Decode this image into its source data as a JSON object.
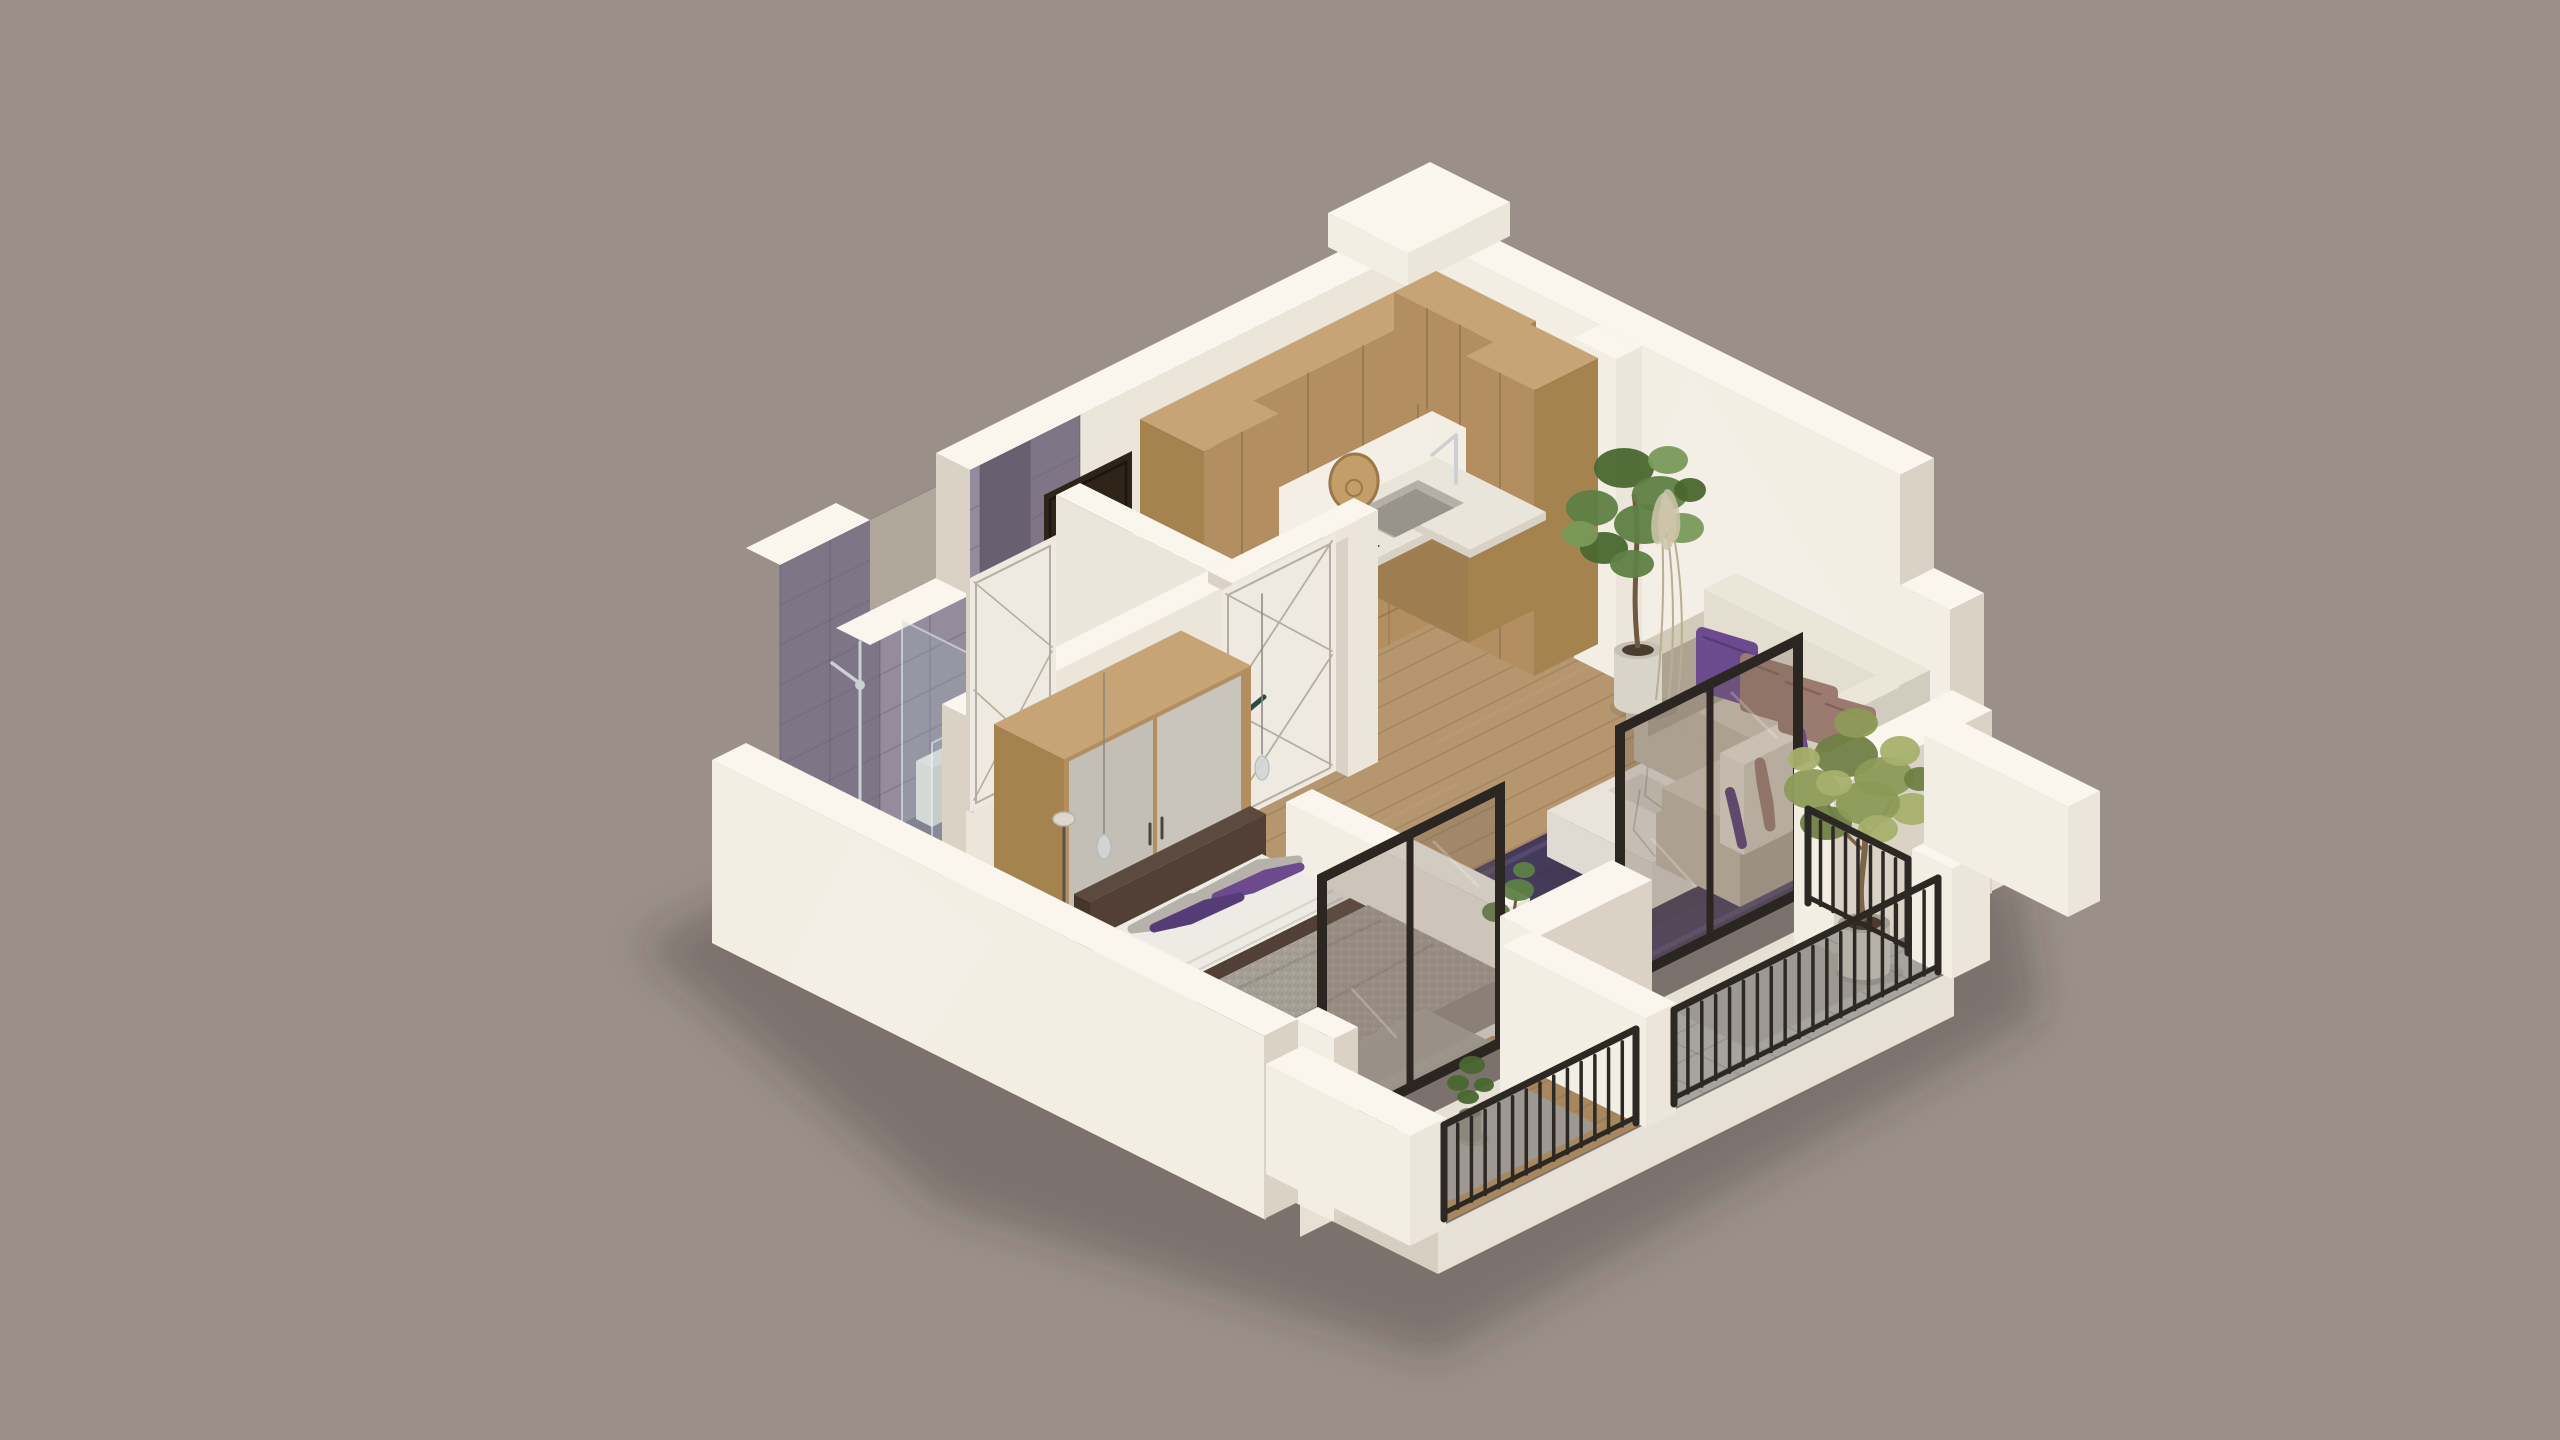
{
  "scene": {
    "type": "isometric-3d-apartment-floor-plan-render",
    "view": "cutaway-axonometric",
    "rooms": [
      {
        "name": "bathroom",
        "features": [
          "marble-tile-wall",
          "window-opening",
          "walk-in-shower-glass",
          "toilet",
          "bathtub",
          "chrome-shower-fixture"
        ]
      },
      {
        "name": "kitchen",
        "features": [
          "l-shaped-wood-cabinets",
          "upper-cabinets",
          "tall-pantry-cabinet",
          "white-countertop",
          "steel-sink",
          "chrome-faucet",
          "dark-cooktop",
          "round-wood-board"
        ]
      },
      {
        "name": "entry-hall",
        "features": [
          "dark-entrance-door",
          "white-door-closed",
          "white-door-open",
          "wardrobe",
          "floor-lamp"
        ]
      },
      {
        "name": "bedroom",
        "features": [
          "double-bed",
          "gray-speckled-blanket",
          "brown-trim",
          "purple-pillows",
          "gray-pillows",
          "pendant-lights",
          "door-mat"
        ]
      },
      {
        "name": "living-room",
        "features": [
          "corner-sofa",
          "cream-back-cushions",
          "purple-accent-pillows",
          "mauve-pillows",
          "purple-rug",
          "marble-coffee-table",
          "potted-ficus",
          "dried-pampas"
        ]
      },
      {
        "name": "balcony-bedroom",
        "features": [
          "glass-door-black-frame",
          "wood-deck-floor",
          "metal-railing",
          "small-potted-plant",
          "door-mat"
        ]
      },
      {
        "name": "balcony-living",
        "features": [
          "glass-door-black-frame",
          "tile-floor",
          "metal-railing",
          "olive-tree-in-concrete-pot",
          "door-mat",
          "white-parapet-piers"
        ]
      }
    ]
  },
  "colors": {
    "background": "#9a9089",
    "wall_top": "#faf6ee",
    "wall_light": "#f3eee4",
    "wall_mid": "#ece6da",
    "wall_shade": "#d9d2c5",
    "wall_dark": "#c7bfb1",
    "slab": "#e7e1d5",
    "slab_shade": "#d5cec1",
    "outside": "#b0a79b",
    "tile_base": "#7e7687",
    "tile_light": "#948b9c",
    "tile_dark": "#686070",
    "grout": "#575064",
    "bath_floor": "#787080",
    "shower_tray": "#888090",
    "wood_cabinet": "#b28e60",
    "wood_cabinet_light": "#c7a475",
    "wood_cabinet_dark": "#96764b",
    "wood_cabinet_side": "#a5834f",
    "counter": "#eae5db",
    "counter_side": "#d8d2c6",
    "cooktop": "#221d18",
    "steel": "#b4b0a8",
    "steel_dark": "#98948c",
    "wood_floor": "#b5966f",
    "wood_floor_dark": "#a8875f",
    "plank_line": "rgba(104,74,44,0.20)",
    "balcony_tile": "#a7a49e",
    "balcony_grid": "rgba(0,0,0,0.10)",
    "door_dark": "#2e2418",
    "door_dark_edge": "#1c1510",
    "door_white": "#efeae1",
    "door_line": "#b5aea0",
    "handle_dark": "#2c4a44",
    "glass_frame": "#2b2621",
    "glass_fill": "rgba(118,102,88,0.30)",
    "glass_shine": "rgba(255,255,255,0.22)",
    "shower_glass": "rgba(158,182,188,0.26)",
    "shower_glass2": "rgba(158,182,188,0.18)",
    "shower_edge": "rgba(235,245,246,0.55)",
    "railing": "#2c2824",
    "sofa": "#c3baa8",
    "sofa_light": "#d3cbba",
    "sofa_shade": "#ada393",
    "sofa_back": "#e4ded1",
    "sofa_back_top": "#ece6d9",
    "sofa_back_shade": "#d2ccbe",
    "pillow_purple": "#6b4a8e",
    "pillow_purple_dark": "#563c76",
    "pillow_mauve": "#9b7a6f",
    "pillow_mauve_dark": "#84615a",
    "rug": "#443a5a",
    "rug_light": "#5a4d73",
    "marble": "#e9e4db",
    "marble_side": "#d9d4ca",
    "marble_side2": "#e0dbd2",
    "marble_vein": "#c2bcb1",
    "bed_sheet": "#edebe4",
    "bed_sheet_shade": "#d9d5cc",
    "blanket": "#a59e95",
    "blanket_dot1": "#958e86",
    "blanket_dot2": "#bdb7ae",
    "blanket_shade": "#938c84",
    "bed_trim": "#524036",
    "bed_trim_dark": "#463629",
    "bed_trim_top": "#5d4a3e",
    "pillow_gray": "#b6b1a9",
    "white_fixture": "#ece9e1",
    "white_fixture_shade": "#dcd8cf",
    "chrome": "#cdd0d2",
    "plant_green": "#5e8044",
    "plant_green_dark": "#49672f",
    "plant_green_light": "#79995a",
    "olive_green": "#8c9a57",
    "olive_dark": "#707f44",
    "olive_light": "#a7b06c",
    "trunk": "#6f5a40",
    "pot_white": "#d9d4c9",
    "pot_white_top": "#c6c1b6",
    "pot_concrete": "#b6b1a6",
    "pot_dark": "#8e887c",
    "soil": "#4a3d30",
    "lamp_glass": "#d4d6d7",
    "lamp_metal": "#8a857e",
    "mat": "#9d9992",
    "mat_in": "#a9a59e",
    "shadow": "rgba(58,50,44,0.30)",
    "soft_shadow": "rgba(58,50,44,0.10)",
    "sun_patch": "rgba(255,250,240,0.15)",
    "pampas": "#cfc4ab",
    "pampas_stem": "#b9ad92"
  }
}
